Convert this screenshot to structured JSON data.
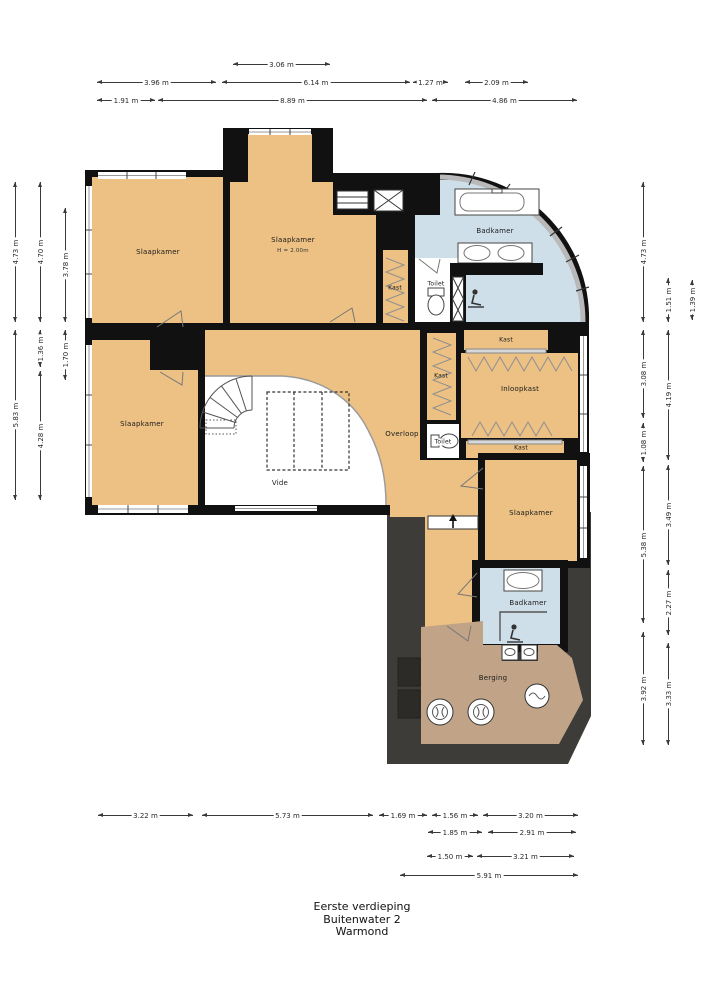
{
  "title": {
    "line1": "Eerste verdieping",
    "line2": "Buitenwater 2",
    "line3": "Warmond"
  },
  "rooms": {
    "slaapkamer_nw": "Slaapkamer",
    "slaapkamer_n": "Slaapkamer",
    "slaapkamer_n_note": "H = 2.00m",
    "badkamer_n": "Badkamer",
    "kast_n": "Kast",
    "toilet_n": "Toilet",
    "kast_e_top": "Kast",
    "kast_w": "Kast",
    "inloopkast": "Inloopkast",
    "overloop": "Overloop",
    "toilet_s": "Toilet",
    "kast_e_bottom": "Kast",
    "vide": "Vide",
    "slaapkamer_sw": "Slaapkamer",
    "slaapkamer_se": "Slaapkamer",
    "badkamer_s": "Badkamer",
    "berging": "Berging"
  },
  "dims": {
    "top": [
      "3.06 m",
      "3.96 m",
      "6.14 m",
      "1.27 m",
      "2.09 m",
      "1.91 m",
      "8.89 m",
      "4.86 m"
    ],
    "left": [
      "4.73 m",
      "5.83 m",
      "4.70 m",
      "1.36 m",
      "4.28 m",
      "3.78 m",
      "1.70 m"
    ],
    "right": [
      "4.73 m",
      "3.08 m",
      "1.08 m",
      "5.38 m",
      "3.92 m",
      "1.51 m",
      "4.19 m",
      "3.49 m",
      "2.27 m",
      "3.33 m",
      "1.39 m"
    ],
    "bottom": [
      "3.22 m",
      "5.73 m",
      "1.69 m",
      "1.56 m",
      "3.20 m",
      "1.85 m",
      "2.91 m",
      "1.50 m",
      "3.21 m",
      "5.91 m"
    ]
  },
  "colors": {
    "room_fill": "#ecc183",
    "bath_fill": "#cfdfe9",
    "storage_fill": "#c1a488",
    "roof_fill": "#3e3c38",
    "wall": "#111111"
  }
}
